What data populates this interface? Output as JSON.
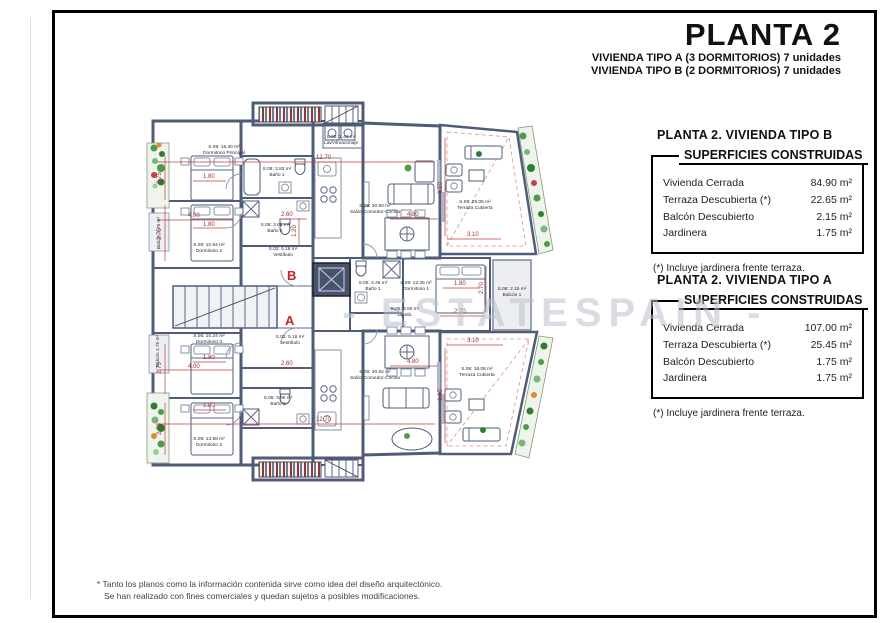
{
  "header": {
    "title": "PLANTA 2",
    "subtitle_a": "VIVIENDA TIPO A (3 DORMITORIOS) 7 unidades",
    "subtitle_b": "VIVIENDA TIPO B (2 DORMITORIOS) 7 unidades"
  },
  "panels": [
    {
      "heading": "PLANTA 2. VIVIENDA TIPO B",
      "table_title": "SUPERFICIES CONSTRUIDAS",
      "rows": [
        {
          "label": "Vivienda Cerrada",
          "value": "84.90 m²"
        },
        {
          "label": "Terraza Descubierta (*)",
          "value": "22.65 m²"
        },
        {
          "label": "Balcón Descubierto",
          "value": "2.15 m²"
        },
        {
          "label": "Jardinera",
          "value": "1.75 m²"
        }
      ],
      "note": "(*) Incluye jardinera frente terraza."
    },
    {
      "heading": "PLANTA 2. VIVIENDA TIPO A",
      "table_title": "SUPERFICIES CONSTRUIDAS",
      "rows": [
        {
          "label": "Vivienda Cerrada",
          "value": "107.00 m²"
        },
        {
          "label": "Terraza Descubierta (*)",
          "value": "25.45 m²"
        },
        {
          "label": "Balcón Descubierto",
          "value": "1.75 m²"
        },
        {
          "label": "Jardinera",
          "value": "1.75 m²"
        }
      ],
      "note": "(*) Incluye jardinera frente terraza."
    }
  ],
  "watermark": "- ESTATESPAIN -",
  "footer": {
    "line1": "* Tanto los planos como la información contenida sirve como idea del diseño arquitectónico.",
    "line2": "Se han realizado con fines comerciales y quedan sujetos a posibles modificaciones."
  },
  "plan": {
    "unit_letters": {
      "b": "B",
      "a": "A"
    },
    "colors": {
      "wall": "#4e5c7a",
      "dimension": "#a03030",
      "plant_green": "#4e9b4e",
      "unit_letter_red": "#cc2222"
    },
    "rooms": [
      {
        "area": "S.08: 18.30 m²",
        "name": "Dormitorio Principal"
      },
      {
        "area": "S.08: 1.43 m²",
        "name": "Lav/Almacenaje"
      },
      {
        "area": "S.08: 3.83 m²",
        "name": "Baño 1"
      },
      {
        "area": "S.08: 10.94 m²",
        "name": "Dormitorio 2"
      },
      {
        "area": "S.08: 3.61 m²",
        "name": "Baño 2"
      },
      {
        "area": "S.08: 30.50 m²",
        "name": "Salón-Comedor-Cocina"
      },
      {
        "area": "S.08: 25.05 m²",
        "name": "Terraza Cubierta"
      },
      {
        "area": "S.08: 2.15 m²",
        "name": "Balcón 1"
      },
      {
        "area": "S.05: 4.46 m²",
        "name": "Baño 1"
      },
      {
        "area": "S.05: 12.25 m²",
        "name": "Dormitorio 1"
      },
      {
        "area": "S.05: 3.60 m²",
        "name": "Distrib."
      },
      {
        "area": "S.02: 5.18 m²",
        "name": "Vestíbulo"
      },
      {
        "area": "S.06: 10.24 m²",
        "name": "Dormitorio 3"
      },
      {
        "area": "S.06: 13.58 m²",
        "name": "Dormitorio 2"
      },
      {
        "area": "S.06: 3.96 m²",
        "name": "Baño 2"
      },
      {
        "area": "S.06: 30.62 m²",
        "name": "Salón-Comedor-Cocina"
      },
      {
        "area": "S.06: 18.08 m²",
        "name": "Terraza Cubierta"
      },
      {
        "area": "Balcón 1.75 m²",
        "name": ""
      },
      {
        "area": "S.02: 5.18 m²",
        "name": "Vestíbulo"
      },
      {
        "area": "Balcón 1.75 m²",
        "name": ""
      }
    ],
    "dims": [
      "12.70",
      "2.75",
      "1.80",
      "4.00",
      "1.80",
      "2.75",
      "2.60",
      "1.20",
      "4.80",
      "3.10",
      "6.60",
      "1.80",
      "2.70",
      "2.70",
      "12.70",
      "2.75",
      "1.80",
      "4.00",
      "2.60",
      "1.80",
      "2.75",
      "4.80",
      "3.10",
      "6.60"
    ]
  }
}
